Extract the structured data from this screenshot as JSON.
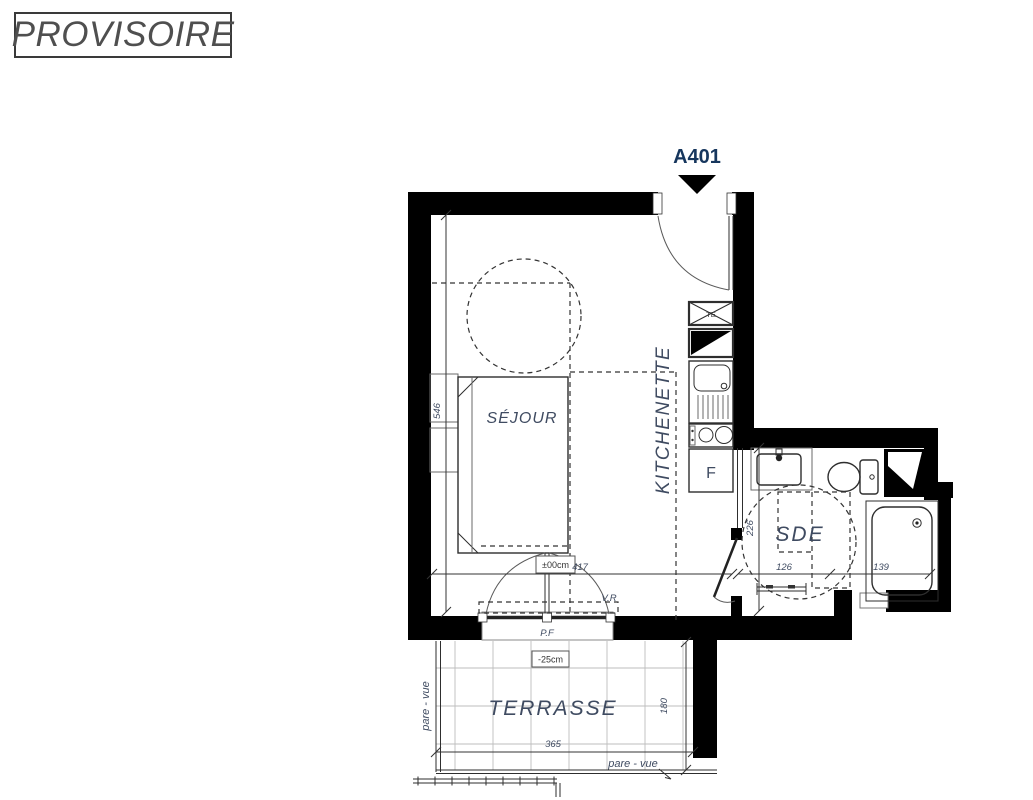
{
  "labels": {
    "stamp": "PROVISOIRE",
    "unit": "A401",
    "sejour": "SÉJOUR",
    "kitchenette": "KITCHENETTE",
    "sde": "SDE",
    "terrasse": "TERRASSE",
    "fridge": "F",
    "electrical_box": "TE",
    "window_door": "P.F",
    "roller_shutter": "V.R",
    "level_interior": "±00cm",
    "level_terrace": "-25cm",
    "screen_left": "pare - vue",
    "screen_bottom": "pare - vue"
  },
  "dimensions_cm": {
    "sejour_width": "417",
    "sejour_depth": "546",
    "sde_width": "126",
    "shower_width": "139",
    "sde_depth": "226",
    "terrace_width": "365",
    "terrace_depth": "180"
  },
  "colors": {
    "wall": "#000000",
    "label": "#3f4b61",
    "unit": "#16365d",
    "stamp": "#4f4f4f"
  }
}
